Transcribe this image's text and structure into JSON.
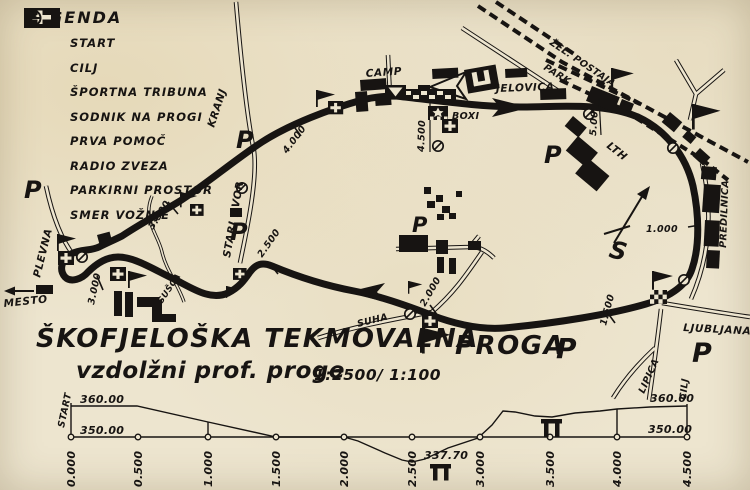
{
  "legend": {
    "title": "LEGENDA",
    "items": [
      {
        "icon": "start-flag-icon",
        "label": "START"
      },
      {
        "icon": "finish-flag-icon",
        "label": "CILJ"
      },
      {
        "icon": "tribune-icon",
        "label": "ŠPORTNA TRIBUNA"
      },
      {
        "icon": "marshal-flag-icon",
        "label": "SODNIK NA PROGI"
      },
      {
        "icon": "first-aid-icon",
        "label": "PRVA POMOČ"
      },
      {
        "icon": "radio-icon",
        "label": "RADIO ZVEZA"
      },
      {
        "icon": "parking-icon",
        "label": "PARKIRNI PROSTOR"
      },
      {
        "icon": "direction-icon",
        "label": "SMER VOŽNJE"
      }
    ]
  },
  "map": {
    "labels": {
      "stari_dvor": "STARI DVOR",
      "kranj": "KRANJ",
      "camp": "CAMP",
      "jelovica": "JELOVICA",
      "boxi": "BOXI",
      "zel_postaja": "ŽEL. POSTAJA",
      "park": "PARK",
      "lth": "LTH",
      "predilnica": "PREDILNICA",
      "ljubljana": "LJUBLJANA",
      "lipica": "LIPICA",
      "cilj": "CILJ",
      "suha": "SUHA",
      "susca": "SUŠCA",
      "plevna": "PLEVNA",
      "mesto": "MESTO",
      "compass_s": "S",
      "parking_p": "P"
    },
    "markers": {
      "m5000": "5.00",
      "m4500": "4.500",
      "m4000": "4.000",
      "m3500": "3.500",
      "m3000": "3.000",
      "m2500": "2.500",
      "m2000": "2.000",
      "m1500": "1.500",
      "m1000": "1.000"
    }
  },
  "title": {
    "line1": "ŠKOFJELOŠKA TEKMOVALNA",
    "proga": "PROGA",
    "line2": "vzdolžni prof. proge",
    "scale": "1:2500/ 1:100"
  },
  "chart_data": {
    "type": "line",
    "title": "vzdolžni prof. proge",
    "scale": "1:2500/ 1:100",
    "x": [
      0.0,
      0.5,
      1.0,
      1.5,
      2.0,
      2.5,
      3.0,
      3.5,
      4.0,
      4.5
    ],
    "x_tick_labels": [
      "0.000",
      "0.500",
      "1.000",
      "1.500",
      "2.000",
      "2.500",
      "3.000",
      "3.500",
      "4.000",
      "4.500"
    ],
    "elevations_approx": [
      360,
      360,
      355,
      350,
      350,
      342,
      350,
      356,
      359,
      360
    ],
    "min_elevation_label": "337.70",
    "y_left_top": "360.00",
    "y_left_bottom": "350.00",
    "y_right_top": "360.00",
    "y_right_bottom": "350.00",
    "start_label": "START",
    "ylim": [
      337.7,
      360
    ],
    "grid": false
  }
}
